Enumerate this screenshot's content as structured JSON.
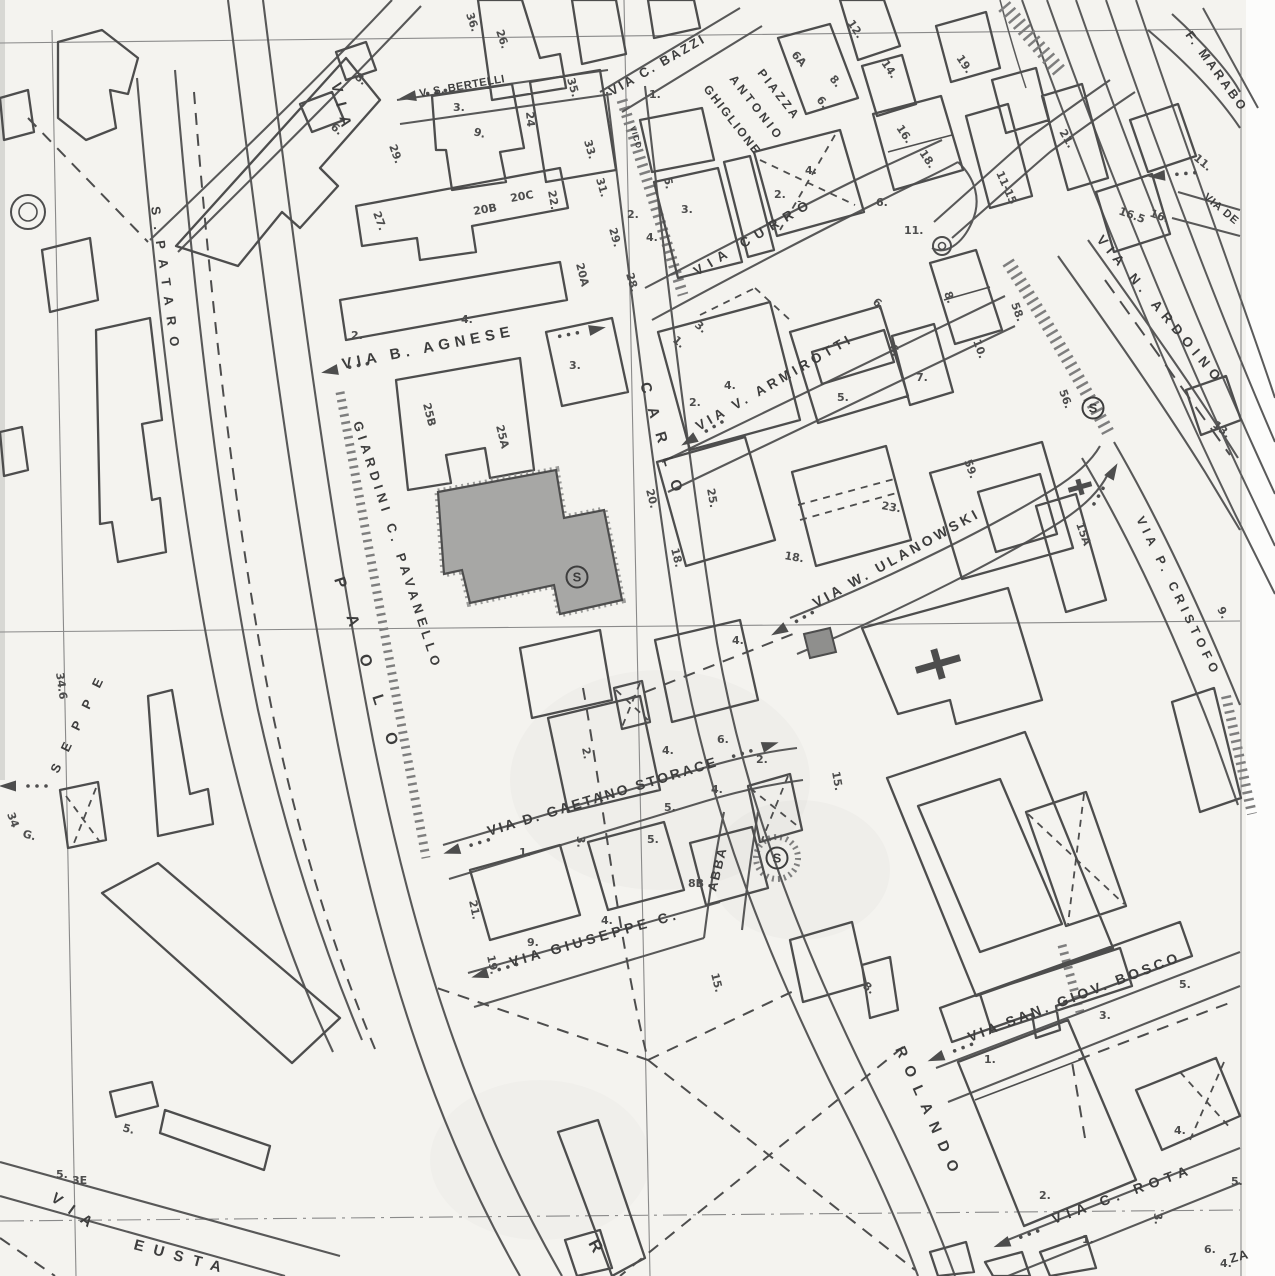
{
  "map": {
    "type": "scanned_cadastral_city_map",
    "colors": {
      "paper": "#f4f3ef",
      "margin": "#fcfcfb",
      "ink": "#3d3d3d",
      "ink2": "#4d4d4d",
      "road_edge": "#585858",
      "grid": "#8a8a8a",
      "hatch": "#7e7e7e",
      "gray_building": "#a7a7a5",
      "dark_building": "#8f8f8d"
    },
    "street_labels": [
      {
        "id": "via-top-left",
        "t": "VIA",
        "x": 331,
        "y": 84,
        "r": 76,
        "s": 15,
        "ls": 10
      },
      {
        "id": "v-s-bertelli",
        "t": "V. S. BERTELLI",
        "x": 420,
        "y": 97,
        "r": -10,
        "s": 11,
        "ls": 0.5
      },
      {
        "id": "via-c-bazzi",
        "t": "VIA C. BAZZI",
        "x": 612,
        "y": 96,
        "r": -30,
        "s": 13,
        "ls": 2.5
      },
      {
        "id": "piazza",
        "t": "PIAZZA",
        "x": 757,
        "y": 73,
        "r": 52,
        "s": 12,
        "ls": 3
      },
      {
        "id": "antonio",
        "t": "ANTONIO",
        "x": 729,
        "y": 79,
        "r": 52,
        "s": 12,
        "ls": 3.5
      },
      {
        "id": "ghiglione",
        "t": "GHIGLIONE",
        "x": 703,
        "y": 89,
        "r": 52,
        "s": 12,
        "ls": 2
      },
      {
        "id": "via-curro",
        "t": "VIA CURRÒ",
        "x": 697,
        "y": 276,
        "r": -31,
        "s": 13.5,
        "ls": 7
      },
      {
        "id": "via-b-agnese",
        "t": "VIA B. AGNESE",
        "x": 343,
        "y": 369,
        "r": -11,
        "s": 15,
        "ls": 5
      },
      {
        "id": "via-v-armirotti",
        "t": "VIA V. ARMIROTTI",
        "x": 699,
        "y": 431,
        "r": -30,
        "s": 13.5,
        "ls": 4
      },
      {
        "id": "carlo",
        "t": "CARLO",
        "x": 640,
        "y": 384,
        "r": 73,
        "s": 15,
        "ls": 15
      },
      {
        "id": "via-w-ulanowski",
        "t": "VIA  W. ULANOWSKI",
        "x": 816,
        "y": 608,
        "r": -29,
        "s": 14,
        "ls": 3.5
      },
      {
        "id": "giardini-c-pavanello",
        "t": "GIARDINI  C. PAVANELLO",
        "x": 353,
        "y": 423,
        "r": 72,
        "s": 13,
        "ls": 5
      },
      {
        "id": "paolo",
        "t": "PAOLO",
        "x": 334,
        "y": 579,
        "r": 72,
        "s": 16,
        "ls": 30
      },
      {
        "id": "spataro",
        "t": "S.PATARO",
        "x": 151,
        "y": 207,
        "r": 82,
        "s": 13,
        "ls": 11
      },
      {
        "id": "seppe",
        "t": "SEPPE",
        "x": 58,
        "y": 774,
        "r": -64,
        "s": 13,
        "ls": 15
      },
      {
        "id": "via-d-gaetano-storace",
        "t": "VIA D. GAETANO STORACE",
        "x": 489,
        "y": 836,
        "r": -17,
        "s": 14,
        "ls": 2.5
      },
      {
        "id": "via-giuseppe-c",
        "t": "VIA GIUSEPPE C.",
        "x": 511,
        "y": 967,
        "r": -16,
        "s": 14,
        "ls": 4
      },
      {
        "id": "abba",
        "t": "ABBA",
        "x": 716,
        "y": 892,
        "r": -76,
        "s": 13,
        "ls": 2
      },
      {
        "id": "rolando",
        "t": "ROLANDO",
        "x": 895,
        "y": 1049,
        "r": 66,
        "s": 15,
        "ls": 10
      },
      {
        "id": "via-san-giov-bosco",
        "t": "VIA SAN. GIOV. BOSCO",
        "x": 970,
        "y": 1042,
        "r": -21,
        "s": 14,
        "ls": 3.5
      },
      {
        "id": "via-c-rota",
        "t": "VIA C. ROTA",
        "x": 1054,
        "y": 1224,
        "r": -20,
        "s": 14,
        "ls": 6
      },
      {
        "id": "via-n-ardoino",
        "t": "VIA N. ARDOINO",
        "x": 1096,
        "y": 240,
        "r": 50,
        "s": 13.5,
        "ls": 6
      },
      {
        "id": "via-p-cristofo",
        "t": "VIA P. CRISTOFO",
        "x": 1136,
        "y": 519,
        "r": 64,
        "s": 12.5,
        "ls": 5
      },
      {
        "id": "f-marabo",
        "t": "F. MARABO",
        "x": 1185,
        "y": 35,
        "r": 54,
        "s": 12.5,
        "ls": 3
      },
      {
        "id": "via-de",
        "t": "VIA DE",
        "x": 1203,
        "y": 198,
        "r": 40,
        "s": 11,
        "ls": 1
      },
      {
        "id": "via-eusta-via",
        "t": "VIA",
        "x": 50,
        "y": 1200,
        "r": 36,
        "s": 15,
        "ls": 11
      },
      {
        "id": "via-eusta",
        "t": "EUSTA",
        "x": 133,
        "y": 1249,
        "r": 15,
        "s": 15,
        "ls": 10
      },
      {
        "id": "r-letter",
        "t": "R",
        "x": 588,
        "y": 1243,
        "r": 62,
        "s": 17,
        "ls": 0
      },
      {
        "id": "vico",
        "t": "VICO",
        "x": 630,
        "y": 127,
        "r": 73,
        "s": 8,
        "ls": 1
      },
      {
        "id": "za",
        "t": "ZA",
        "x": 1231,
        "y": 1263,
        "r": -15,
        "s": 13,
        "ls": 1
      }
    ],
    "house_numbers": [
      [
        "36.",
        466,
        14,
        72
      ],
      [
        "26.",
        496,
        31,
        72
      ],
      [
        "35.",
        567,
        79,
        74
      ],
      [
        "33.",
        584,
        141,
        74
      ],
      [
        "31.",
        596,
        179,
        74
      ],
      [
        "29.",
        609,
        229,
        74
      ],
      [
        "28.",
        626,
        274,
        74
      ],
      [
        "3.",
        453,
        111,
        0
      ],
      [
        "9.",
        473,
        135,
        15
      ],
      [
        "24",
        526,
        112,
        85
      ],
      [
        "20B",
        474,
        215,
        -10
      ],
      [
        "20C",
        511,
        202,
        -10
      ],
      [
        "22.",
        548,
        191,
        80
      ],
      [
        "20A",
        576,
        264,
        76
      ],
      [
        "27.",
        373,
        213,
        70
      ],
      [
        "29.",
        389,
        146,
        70
      ],
      [
        "6.",
        330,
        128,
        40
      ],
      [
        "8.",
        354,
        78,
        40
      ],
      [
        "2.",
        351,
        339,
        0
      ],
      [
        "4.",
        461,
        323,
        0
      ],
      [
        "1.",
        649,
        98,
        0
      ],
      [
        "6A",
        791,
        55,
        50
      ],
      [
        "8.",
        829,
        79,
        50
      ],
      [
        "6.",
        816,
        100,
        50
      ],
      [
        "12.",
        847,
        23,
        56
      ],
      [
        "14.",
        881,
        63,
        56
      ],
      [
        "19.",
        956,
        58,
        56
      ],
      [
        "16.",
        896,
        128,
        56
      ],
      [
        "18.",
        919,
        153,
        56
      ],
      [
        "2.",
        774,
        198,
        0
      ],
      [
        "4.",
        805,
        174,
        0
      ],
      [
        "5.",
        664,
        178,
        80
      ],
      [
        "3.",
        681,
        213,
        0
      ],
      [
        "4.",
        646,
        241,
        0
      ],
      [
        "2.",
        627,
        218,
        0
      ],
      [
        "6.",
        876,
        206,
        0
      ],
      [
        "11.",
        904,
        234,
        0
      ],
      [
        "21.",
        1059,
        132,
        60
      ],
      [
        "11-15",
        996,
        173,
        66
      ],
      [
        "11.",
        1193,
        159,
        40
      ],
      [
        "16.5",
        1118,
        214,
        20
      ],
      [
        "16.",
        1149,
        216,
        20
      ],
      [
        "13.",
        1212,
        426,
        40
      ],
      [
        "3.",
        569,
        369,
        0
      ],
      [
        "25B",
        423,
        404,
        76
      ],
      [
        "25A",
        496,
        426,
        76
      ],
      [
        "20.",
        646,
        490,
        76
      ],
      [
        "18.",
        671,
        549,
        76
      ],
      [
        "3.",
        694,
        326,
        40
      ],
      [
        "1.",
        672,
        341,
        40
      ],
      [
        "2.",
        689,
        406,
        0
      ],
      [
        "4.",
        724,
        389,
        0
      ],
      [
        "6.",
        872,
        303,
        40
      ],
      [
        "5.",
        837,
        401,
        0
      ],
      [
        "7.",
        916,
        381,
        0
      ],
      [
        "6.",
        889,
        346,
        70
      ],
      [
        "8.",
        944,
        293,
        70
      ],
      [
        "10.",
        973,
        341,
        70
      ],
      [
        "58.",
        1011,
        304,
        70
      ],
      [
        "56.",
        1059,
        391,
        70
      ],
      [
        "59.",
        964,
        461,
        70
      ],
      [
        "25.",
        707,
        489,
        80
      ],
      [
        "23.",
        881,
        509,
        10
      ],
      [
        "18.",
        784,
        559,
        10
      ],
      [
        "15A",
        1076,
        524,
        70
      ],
      [
        "9.",
        1217,
        609,
        64
      ],
      [
        "2.",
        582,
        748,
        80
      ],
      [
        "3.",
        577,
        836,
        88
      ],
      [
        "4.",
        732,
        644,
        0
      ],
      [
        "4.",
        662,
        754,
        0
      ],
      [
        "6.",
        717,
        743,
        0
      ],
      [
        "5.",
        664,
        811,
        0
      ],
      [
        "4.",
        711,
        793,
        0
      ],
      [
        "2.",
        756,
        763,
        0
      ],
      [
        "21.",
        469,
        901,
        78
      ],
      [
        "19.",
        487,
        956,
        78
      ],
      [
        "9.",
        527,
        946,
        0
      ],
      [
        "4.",
        601,
        924,
        0
      ],
      [
        "8B",
        688,
        887,
        0
      ],
      [
        "5.",
        647,
        843,
        0
      ],
      [
        "1.",
        519,
        856,
        0
      ],
      [
        "15.",
        711,
        974,
        76
      ],
      [
        "15.",
        832,
        772,
        80
      ],
      [
        "8.",
        862,
        987,
        40
      ],
      [
        "5.",
        1179,
        988,
        0
      ],
      [
        "3.",
        1099,
        1019,
        0
      ],
      [
        "1.",
        984,
        1063,
        0
      ],
      [
        "4.",
        1174,
        1134,
        0
      ],
      [
        "2.",
        1039,
        1199,
        0
      ],
      [
        "1.",
        1082,
        1243,
        0
      ],
      [
        "6.",
        1204,
        1253,
        0
      ],
      [
        "3.",
        1154,
        1213,
        85
      ],
      [
        "5.",
        1231,
        1185,
        0
      ],
      [
        "4.",
        1220,
        1267,
        0
      ],
      [
        "5.",
        122,
        1131,
        15
      ],
      [
        "5.",
        56,
        1178,
        0
      ],
      [
        "3E",
        72,
        1184,
        0
      ],
      [
        "34.6",
        56,
        673,
        82
      ],
      [
        "G.",
        22,
        837,
        15
      ],
      [
        "34",
        7,
        814,
        70
      ]
    ],
    "symbols": {
      "s_letter": "S",
      "s_markers": [
        {
          "x": 577,
          "y": 577
        },
        {
          "x": 777,
          "y": 858
        },
        {
          "x": 1093,
          "y": 408
        }
      ],
      "double_circles": [
        {
          "x": 28,
          "y": 212,
          "r1": 17,
          "r2": 9
        },
        {
          "x": 942,
          "y": 246,
          "r1": 9,
          "r2": 3.5
        }
      ],
      "crosses": [
        {
          "x": 938,
          "y": 664,
          "r": -16,
          "l": 46,
          "w": 7
        },
        {
          "x": 1080,
          "y": 487,
          "r": -16,
          "l": 24,
          "w": 5
        }
      ],
      "arrows": [
        [
          408,
          97,
          -10
        ],
        [
          330,
          371,
          -11
        ],
        [
          597,
          329,
          169
        ],
        [
          689,
          441,
          -30
        ],
        [
          452,
          851,
          -17
        ],
        [
          770,
          745,
          163
        ],
        [
          480,
          975,
          -16
        ],
        [
          936,
          1058,
          -21
        ],
        [
          1002,
          1244,
          -20
        ],
        [
          779,
          631,
          -29
        ],
        [
          1113,
          471,
          120
        ],
        [
          1157,
          176,
          -5
        ],
        [
          8,
          786,
          0
        ]
      ]
    }
  }
}
